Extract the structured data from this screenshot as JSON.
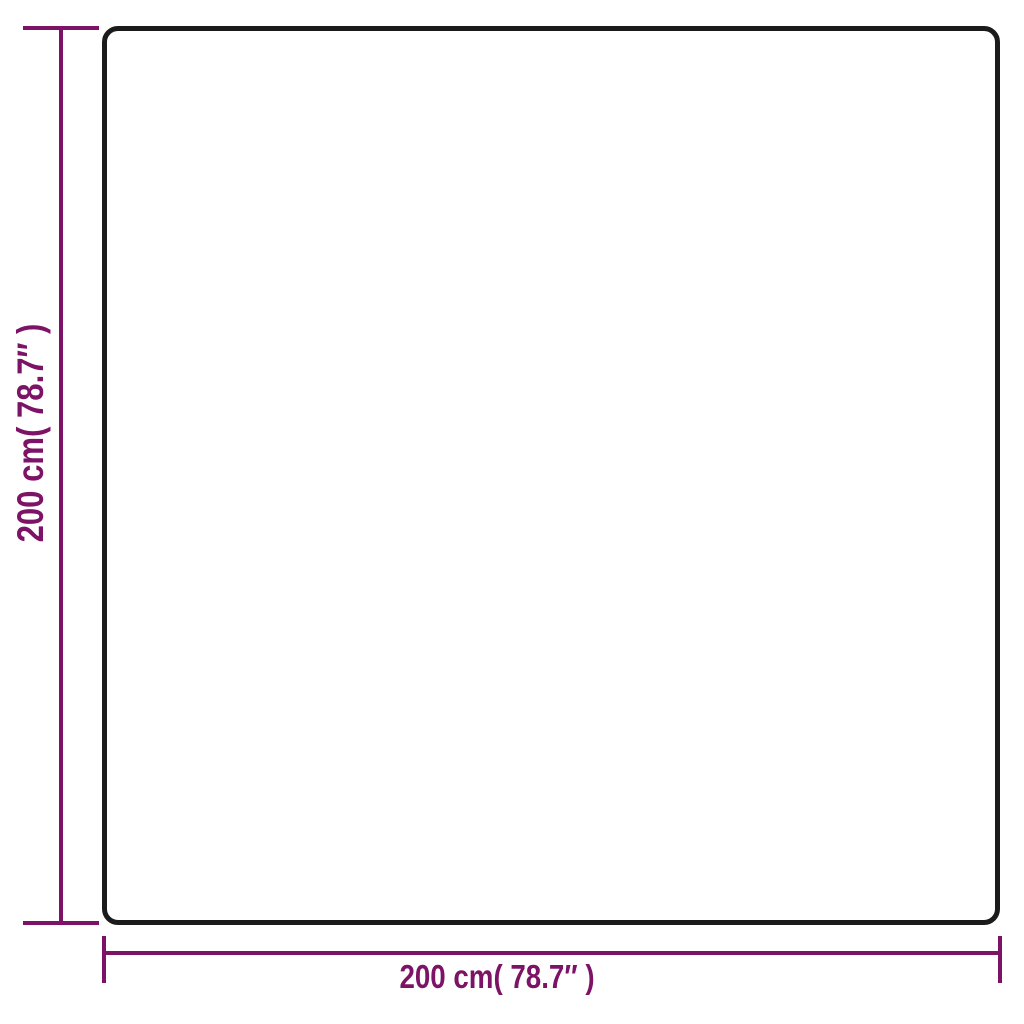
{
  "figure": {
    "type": "product-dimension-diagram",
    "shape": "rounded-square",
    "background": "plain-white"
  },
  "colors": {
    "dimension_accent": "#7c1366",
    "outline": "#1b1b1b",
    "background": "#ffffff"
  },
  "dimensions": {
    "height": {
      "label": "200 cm( 78.7″ )",
      "value_cm": 200,
      "value_inches": 78.7,
      "orientation": "vertical"
    },
    "width": {
      "label": "200 cm( 78.7″ )",
      "value_cm": 200,
      "value_inches": 78.7,
      "orientation": "horizontal"
    }
  }
}
